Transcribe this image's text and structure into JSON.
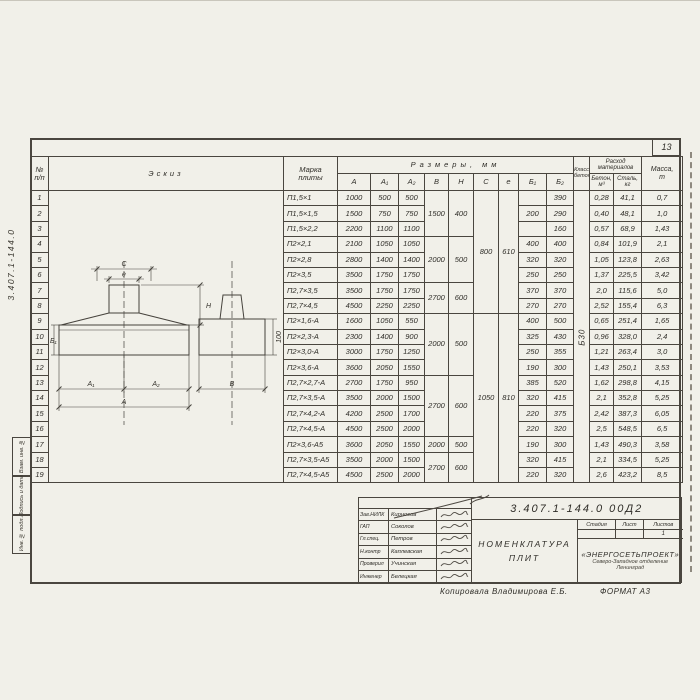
{
  "page": {
    "number": "13",
    "copied_by": "Копировала Владимирова Е.Б.",
    "format_note": "ФОРМАТ А3"
  },
  "margin": {
    "doc_number_vertical": "3.407.1-144.0",
    "side_boxes": [
      "Взам. инв. №",
      "Подпись и дата",
      "Инв. № подл."
    ]
  },
  "table": {
    "headers": {
      "no_line1": "№",
      "no_line2": "п/п",
      "sketch": "Эскиз",
      "mark_line1": "Марка",
      "mark_line2": "плиты",
      "dims_group": "Размеры, мм",
      "dim_cols": [
        "A",
        "A₁",
        "A₂",
        "B",
        "H",
        "C",
        "e",
        "Б₁",
        "Б₂"
      ],
      "class_line1": "Класс",
      "class_line2": "бетона",
      "consumption_line1": "Расход",
      "consumption_line2": "материалов",
      "concrete_line1": "Бетон,",
      "concrete_line2": "м³",
      "steel_line1": "Сталь,",
      "steel_line2": "кг",
      "mass_line1": "Масса,",
      "mass_line2": "т"
    },
    "concrete_class": "Б30",
    "rows": [
      {
        "n": "1",
        "mark": "П1,5×1",
        "dims": [
          "1000",
          "500",
          "500",
          {
            "t": "1500",
            "s": 3
          },
          {
            "t": "400",
            "s": 3
          },
          {
            "t": "800",
            "s": 8
          },
          {
            "t": "610",
            "s": 8
          },
          "",
          "390",
          {
            "t": "Б30",
            "s": 19
          },
          "0,28",
          "41,1",
          "0,7"
        ]
      },
      {
        "n": "2",
        "mark": "П1,5×1,5",
        "dims": [
          "1500",
          "750",
          "750",
          null,
          null,
          null,
          null,
          "200",
          "290",
          null,
          "0,40",
          "48,1",
          "1,0"
        ]
      },
      {
        "n": "3",
        "mark": "П1,5×2,2",
        "dims": [
          "2200",
          "1100",
          "1100",
          null,
          null,
          null,
          null,
          "",
          "160",
          null,
          "0,57",
          "68,9",
          "1,43"
        ]
      },
      {
        "n": "4",
        "mark": "П2×2,1",
        "dims": [
          "2100",
          "1050",
          "1050",
          {
            "t": "2000",
            "s": 3
          },
          {
            "t": "500",
            "s": 3
          },
          null,
          null,
          "400",
          "400",
          null,
          "0,84",
          "101,9",
          "2,1"
        ]
      },
      {
        "n": "5",
        "mark": "П2×2,8",
        "dims": [
          "2800",
          "1400",
          "1400",
          null,
          null,
          null,
          null,
          "320",
          "320",
          null,
          "1,05",
          "123,8",
          "2,63"
        ]
      },
      {
        "n": "6",
        "mark": "П2×3,5",
        "dims": [
          "3500",
          "1750",
          "1750",
          null,
          null,
          null,
          null,
          "250",
          "250",
          null,
          "1,37",
          "225,5",
          "3,42"
        ]
      },
      {
        "n": "7",
        "mark": "П2,7×3,5",
        "dims": [
          "3500",
          "1750",
          "1750",
          {
            "t": "2700",
            "s": 2
          },
          {
            "t": "600",
            "s": 2
          },
          null,
          null,
          "370",
          "370",
          null,
          "2,0",
          "115,6",
          "5,0"
        ]
      },
      {
        "n": "8",
        "mark": "П2,7×4,5",
        "dims": [
          "4500",
          "2250",
          "2250",
          null,
          null,
          null,
          null,
          "270",
          "270",
          null,
          "2,52",
          "155,4",
          "6,3"
        ]
      },
      {
        "n": "9",
        "mark": "П2×1,6-А",
        "dims": [
          "1600",
          "1050",
          "550",
          {
            "t": "2000",
            "s": 4
          },
          {
            "t": "500",
            "s": 4
          },
          {
            "t": "1050",
            "s": 11
          },
          {
            "t": "810",
            "s": 11
          },
          "400",
          "500",
          null,
          "0,65",
          "251,4",
          "1,65"
        ]
      },
      {
        "n": "10",
        "mark": "П2×2,3-А",
        "dims": [
          "2300",
          "1400",
          "900",
          null,
          null,
          null,
          null,
          "325",
          "430",
          null,
          "0,96",
          "328,0",
          "2,4"
        ]
      },
      {
        "n": "11",
        "mark": "П2×3,0-А",
        "dims": [
          "3000",
          "1750",
          "1250",
          null,
          null,
          null,
          null,
          "250",
          "355",
          null,
          "1,21",
          "263,4",
          "3,0"
        ]
      },
      {
        "n": "12",
        "mark": "П2×3,6-А",
        "dims": [
          "3600",
          "2050",
          "1550",
          null,
          null,
          null,
          null,
          "190",
          "300",
          null,
          "1,43",
          "250,1",
          "3,53"
        ]
      },
      {
        "n": "13",
        "mark": "П2,7×2,7-А",
        "dims": [
          "2700",
          "1750",
          "950",
          {
            "t": "2700",
            "s": 4
          },
          {
            "t": "600",
            "s": 4
          },
          null,
          null,
          "385",
          "520",
          null,
          "1,62",
          "298,8",
          "4,15"
        ]
      },
      {
        "n": "14",
        "mark": "П2,7×3,5-А",
        "dims": [
          "3500",
          "2000",
          "1500",
          null,
          null,
          null,
          null,
          "320",
          "415",
          null,
          "2,1",
          "352,8",
          "5,25"
        ]
      },
      {
        "n": "15",
        "mark": "П2,7×4,2-А",
        "dims": [
          "4200",
          "2500",
          "1700",
          null,
          null,
          null,
          null,
          "220",
          "375",
          null,
          "2,42",
          "387,3",
          "6,05"
        ]
      },
      {
        "n": "16",
        "mark": "П2,7×4,5-А",
        "dims": [
          "4500",
          "2500",
          "2000",
          null,
          null,
          null,
          null,
          "220",
          "320",
          null,
          "2,5",
          "548,5",
          "6,5"
        ]
      },
      {
        "n": "17",
        "mark": "П2×3,6-А5",
        "dims": [
          "3600",
          "2050",
          "1550",
          "2000",
          "500",
          null,
          null,
          "190",
          "300",
          null,
          "1,43",
          "490,3",
          "3,58"
        ]
      },
      {
        "n": "18",
        "mark": "П2,7×3,5-А5",
        "dims": [
          "3500",
          "2000",
          "1500",
          {
            "t": "2700",
            "s": 2
          },
          {
            "t": "600",
            "s": 2
          },
          null,
          null,
          "320",
          "415",
          null,
          "2,1",
          "334,5",
          "5,25"
        ]
      },
      {
        "n": "19",
        "mark": "П2,7×4,5-А5",
        "dims": [
          "4500",
          "2500",
          "2000",
          null,
          null,
          null,
          null,
          "220",
          "320",
          null,
          "2,6",
          "423,2",
          "8,5"
        ]
      }
    ]
  },
  "sketch": {
    "labels": {
      "c": "C",
      "e": "e",
      "h": "H",
      "b1": "Б₁",
      "a1": "A₁",
      "a2": "A₂",
      "a": "A",
      "b": "B",
      "hundred": "100"
    }
  },
  "stamp": {
    "doc_number": "3.407.1-144.0   00Д2",
    "title_line1": "Номенклатура",
    "title_line2": "плит",
    "stage_label": "Стадия",
    "sheet_label": "Лист",
    "sheets_label": "Листов",
    "stage_value": "",
    "sheet_value": "",
    "sheets_value": "1",
    "org_line1": "«ЭНЕРГОСЕТЬПРОЕКТ»",
    "org_line2": "Северо-Западное отделение",
    "org_line3": "Ленинград",
    "signatures": [
      {
        "role": "Зав.НИЛК",
        "name": "Кирносов"
      },
      {
        "role": "ГАП",
        "name": "Соколов"
      },
      {
        "role": "Гл.спец.",
        "name": "Петров"
      },
      {
        "role": "Н.контр",
        "name": "Каплевская"
      },
      {
        "role": "Проверил",
        "name": "Учинская"
      },
      {
        "role": "Инженер",
        "name": "Белецкая"
      }
    ]
  },
  "colors": {
    "ink": "#4a463f",
    "paper": "#f1f0e9"
  }
}
